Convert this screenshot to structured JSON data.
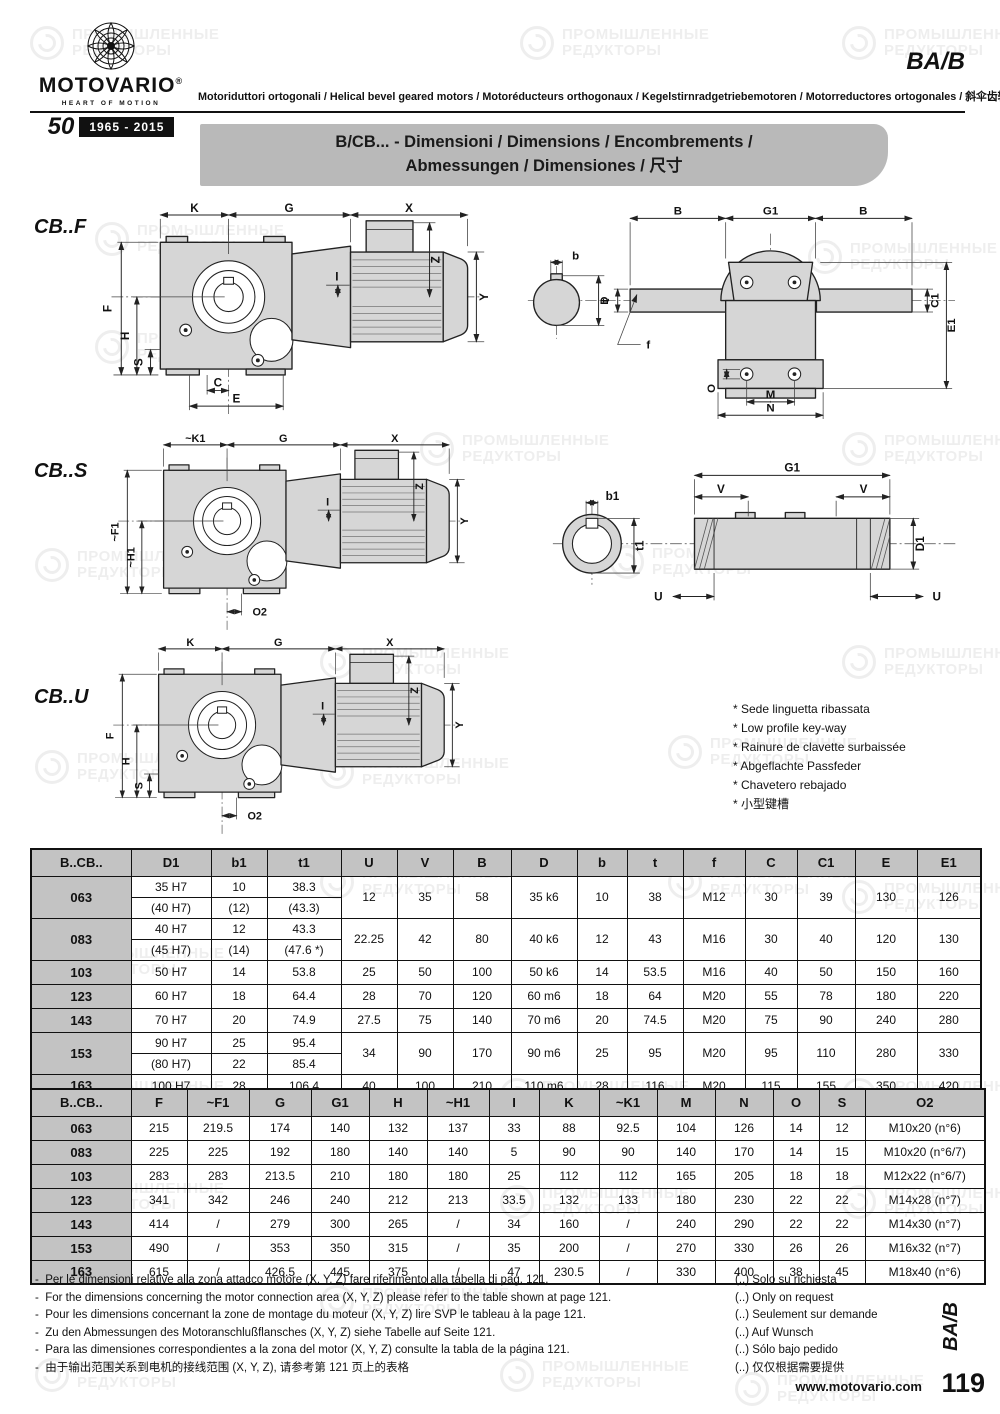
{
  "watermark": {
    "line1": "ПРОМЫШЛЕННЫЕ",
    "line2": "РЕДУКТОРЫ"
  },
  "header": {
    "brand": "MOTOVARIO",
    "registered": "®",
    "tagline": "HEART OF MOTION",
    "anniversary_number": "50",
    "anniversary_years": "1965 - 2015",
    "code": "BA/B",
    "subtitle": "Motoriduttori ortogonali / Helical bevel geared motors / Motoréducteurs orthogonaux / Kegelstirnradgetriebemotoren / Motorreductores ortogonales / 斜伞齿轮减速机"
  },
  "banner": {
    "line1": "B/CB... - Dimensioni / Dimensions / Encombrements /",
    "line2": "Abmessungen / Dimensiones / 尺寸"
  },
  "sections": {
    "cbf": "CB..F",
    "cbs": "CB..S",
    "cbu": "CB..U"
  },
  "dims": {
    "cbf": {
      "k": "K",
      "g": "G",
      "x": "X",
      "f": "F",
      "h": "H",
      "s": "S",
      "c": "C",
      "e": "E",
      "z": "Z",
      "y": "Y",
      "i": "I"
    },
    "cbf_front": {
      "b_left": "B",
      "g1": "G1",
      "b_right": "B",
      "b": "b",
      "t": "t",
      "d": "D",
      "f": "f",
      "o": "O",
      "c1": "C1",
      "e1": "E1",
      "m": "M",
      "n": "N"
    },
    "cbs": {
      "k1": "~K1",
      "g": "G",
      "x": "X",
      "f1": "~F1",
      "h1": "~H1",
      "o2": "O2",
      "z": "Z",
      "y": "Y",
      "i": "I"
    },
    "cbs_shaft": {
      "b1": "b1",
      "t1": "t1",
      "g1": "G1",
      "v_left": "V",
      "v_right": "V",
      "d1": "D1",
      "u_left": "U",
      "u_right": "U"
    },
    "cbu": {
      "k": "K",
      "g": "G",
      "x": "X",
      "f": "F",
      "h": "H",
      "s": "S",
      "o2": "O2",
      "z": "Z",
      "y": "Y",
      "i": "I"
    }
  },
  "keyway_notes": [
    "* Sede linguetta ribassata",
    "* Low profile key-way",
    "* Rainure de clavette surbaissée",
    "* Abgeflachte Passfeder",
    "* Chavetero rebajado",
    "* 小型键槽"
  ],
  "table1": {
    "headers": [
      "B..CB..",
      "D1",
      "b1",
      "t1",
      "U",
      "V",
      "B",
      "D",
      "b",
      "t",
      "f",
      "C",
      "C1",
      "E",
      "E1"
    ],
    "rows": [
      {
        "model": "063",
        "sub": [
          [
            "35 H7",
            "10",
            "38.3"
          ],
          [
            "(40 H7)",
            "(12)",
            "(43.3)"
          ]
        ],
        "rest": [
          "12",
          "35",
          "58",
          "35 k6",
          "10",
          "38",
          "M12",
          "30",
          "39",
          "130",
          "126"
        ]
      },
      {
        "model": "083",
        "sub": [
          [
            "40 H7",
            "12",
            "43.3"
          ],
          [
            "(45 H7)",
            "(14)",
            "(47.6 *)"
          ]
        ],
        "rest": [
          "22.25",
          "42",
          "80",
          "40 k6",
          "12",
          "43",
          "M16",
          "30",
          "40",
          "120",
          "130"
        ]
      },
      {
        "model": "103",
        "sub": [
          [
            "50 H7",
            "14",
            "53.8"
          ]
        ],
        "rest": [
          "25",
          "50",
          "100",
          "50 k6",
          "14",
          "53.5",
          "M16",
          "40",
          "50",
          "150",
          "160"
        ]
      },
      {
        "model": "123",
        "sub": [
          [
            "60 H7",
            "18",
            "64.4"
          ]
        ],
        "rest": [
          "28",
          "70",
          "120",
          "60 m6",
          "18",
          "64",
          "M20",
          "55",
          "78",
          "180",
          "220"
        ]
      },
      {
        "model": "143",
        "sub": [
          [
            "70 H7",
            "20",
            "74.9"
          ]
        ],
        "rest": [
          "27.5",
          "75",
          "140",
          "70 m6",
          "20",
          "74.5",
          "M20",
          "75",
          "90",
          "240",
          "280"
        ]
      },
      {
        "model": "153",
        "sub": [
          [
            "90 H7",
            "25",
            "95.4"
          ],
          [
            "(80 H7)",
            "22",
            "85.4"
          ]
        ],
        "rest": [
          "34",
          "90",
          "170",
          "90 m6",
          "25",
          "95",
          "M20",
          "95",
          "110",
          "280",
          "330"
        ]
      },
      {
        "model": "163",
        "sub": [
          [
            "100 H7",
            "28",
            "106.4"
          ]
        ],
        "rest": [
          "40",
          "100",
          "210",
          "110 m6",
          "28",
          "116",
          "M20",
          "115",
          "155",
          "350",
          "420"
        ]
      }
    ]
  },
  "table2": {
    "headers": [
      "B..CB..",
      "F",
      "~F1",
      "G",
      "G1",
      "H",
      "~H1",
      "I",
      "K",
      "~K1",
      "M",
      "N",
      "O",
      "S",
      "O2"
    ],
    "rows": [
      {
        "model": "063",
        "cells": [
          "215",
          "219.5",
          "174",
          "140",
          "132",
          "137",
          "33",
          "88",
          "92.5",
          "104",
          "126",
          "14",
          "12",
          "M10x20 (n°6)"
        ]
      },
      {
        "model": "083",
        "cells": [
          "225",
          "225",
          "192",
          "180",
          "140",
          "140",
          "5",
          "90",
          "90",
          "140",
          "170",
          "14",
          "15",
          "M10x20 (n°6/7)"
        ]
      },
      {
        "model": "103",
        "cells": [
          "283",
          "283",
          "213.5",
          "210",
          "180",
          "180",
          "25",
          "112",
          "112",
          "165",
          "205",
          "18",
          "18",
          "M12x22 (n°6/7)"
        ]
      },
      {
        "model": "123",
        "cells": [
          "341",
          "342",
          "246",
          "240",
          "212",
          "213",
          "33.5",
          "132",
          "133",
          "180",
          "230",
          "22",
          "22",
          "M14x28 (n°7)"
        ]
      },
      {
        "model": "143",
        "cells": [
          "414",
          "/",
          "279",
          "300",
          "265",
          "/",
          "34",
          "160",
          "/",
          "240",
          "290",
          "22",
          "22",
          "M14x30 (n°7)"
        ]
      },
      {
        "model": "153",
        "cells": [
          "490",
          "/",
          "353",
          "350",
          "315",
          "/",
          "35",
          "200",
          "/",
          "270",
          "330",
          "26",
          "26",
          "M16x32 (n°7)"
        ]
      },
      {
        "model": "163",
        "cells": [
          "615",
          "/",
          "426.5",
          "445",
          "375",
          "/",
          "47",
          "230.5",
          "/",
          "330",
          "400",
          "38",
          "45",
          "M18x40 (n°6)"
        ]
      }
    ]
  },
  "footnotes": {
    "dash": "-",
    "left": [
      "Per le dimensioni relative alla zona attacco motore (X, Y, Z) fare riferimento alla tabella di pag. 121.",
      "For the dimensions concerning the motor connection area (X, Y, Z) please refer to the table shown at page 121.",
      "Pour les dimensions concernant la zone de montage du moteur (X, Y, Z) lire SVP le tableau à la page 121.",
      "Zu den Abmessungen des Motoranschlußflansches (X, Y, Z) siehe Tabelle auf Seite 121.",
      "Para las dimensiones correspondientes a la zona del motor (X, Y, Z) consulte la tabla de la página 121.",
      "由于输出范围关系到电机的接线范围 (X, Y, Z), 请参考第 121 页上的表格"
    ],
    "right": [
      "(..) Solo su richiesta",
      "(..) Only on request",
      "(..) Seulement sur demande",
      "(..) Auf Wunsch",
      "(..) Sólo bajo pedido",
      "(..) 仅仅根据需要提供"
    ]
  },
  "footer": {
    "website": "www.motovario.com",
    "page": "119",
    "side_code": "BA/B"
  },
  "colors": {
    "banner": "#b9b9b9",
    "table_header": "#c3c3c3",
    "drawing_fill": "#d6d6d6",
    "ink": "#111111"
  }
}
